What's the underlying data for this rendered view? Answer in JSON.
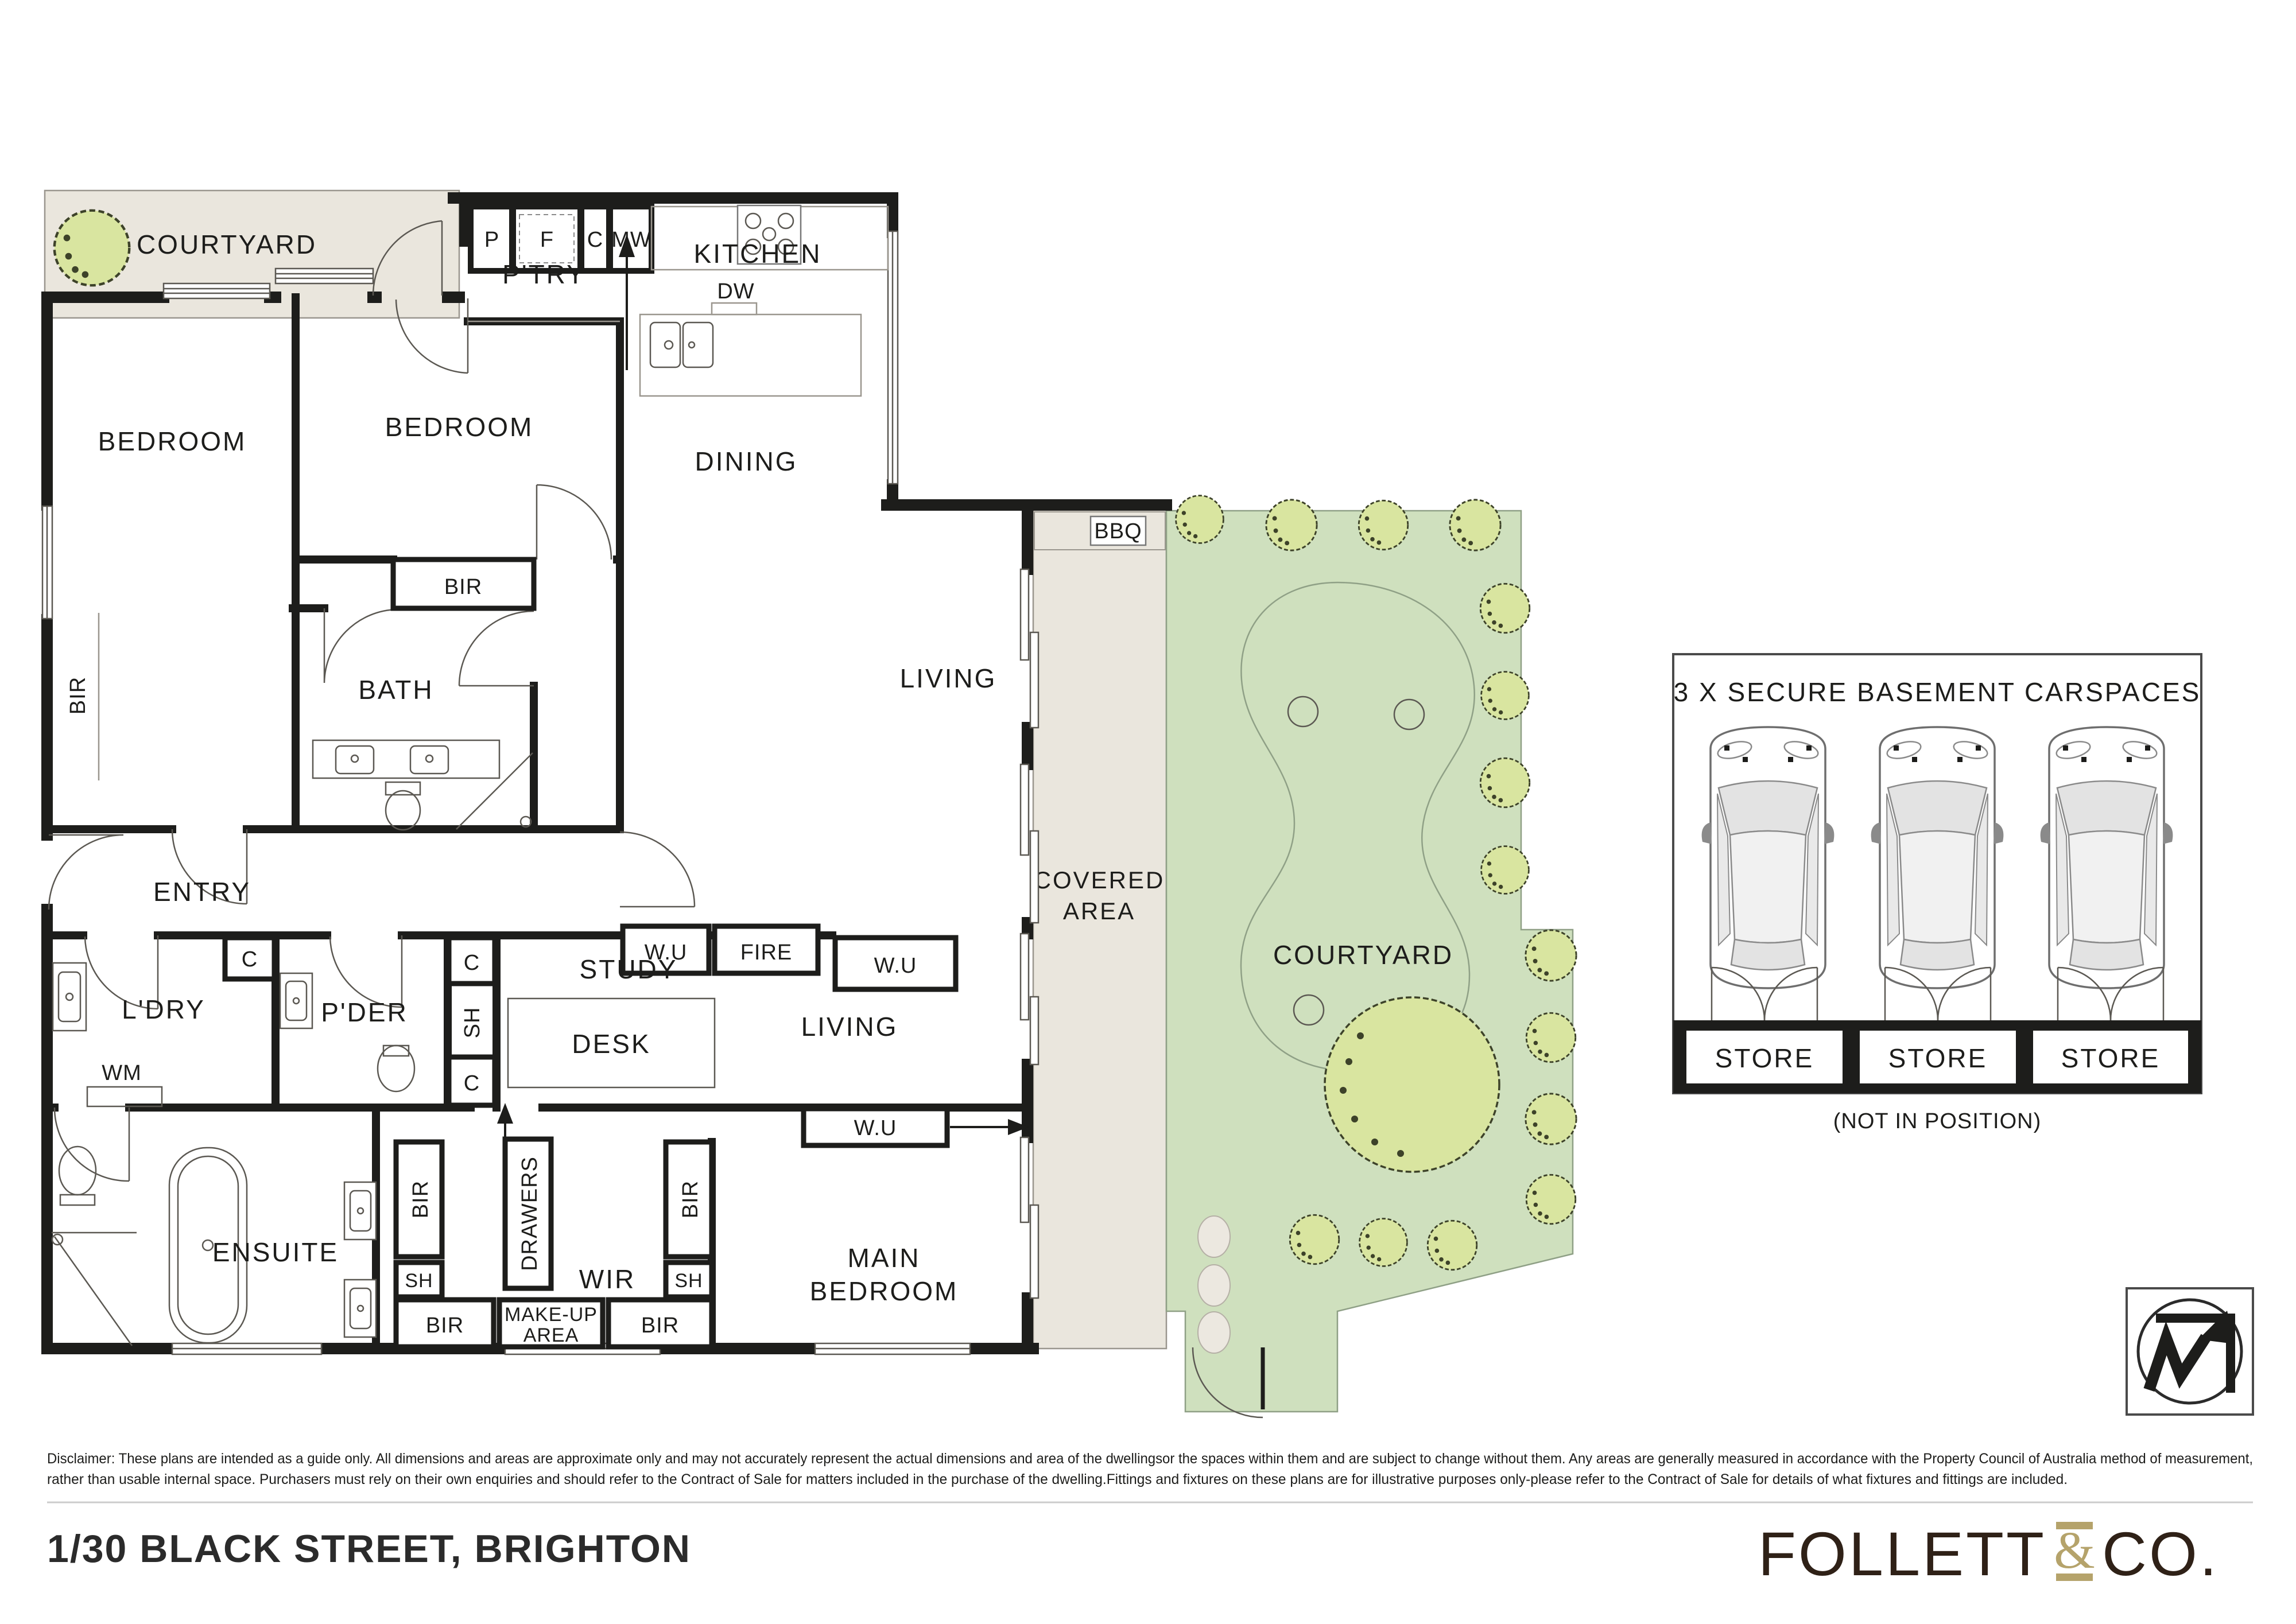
{
  "labels": {
    "courtyard": "COURTYARD",
    "ptry": "P'TRY",
    "kitchen": "KITCHEN",
    "dw": "DW",
    "dining": "DINING",
    "bedroom": "BEDROOM",
    "bir": "BIR",
    "bath": "BATH",
    "entry": "ENTRY",
    "living": "LIVING",
    "wu": "W.U",
    "fire": "FIRE",
    "study": "STUDY",
    "desk": "DESK",
    "ldry": "L'DRY",
    "wm": "WM",
    "pder": "P'DER",
    "c": "C",
    "sh": "SH",
    "p": "P",
    "f": "F",
    "mw": "MW",
    "bbq": "BBQ",
    "covered1": "COVERED",
    "covered2": "AREA",
    "courtyard_main": "COURTYARD",
    "main1": "MAIN",
    "main2": "BEDROOM",
    "ensuite": "ENSUITE",
    "wir": "WIR",
    "drawers": "DRAWERS",
    "makeup1": "MAKE-UP",
    "makeup2": "AREA"
  },
  "carspaces": {
    "title": "3 X SECURE BASEMENT CARSPACES",
    "store": "STORE",
    "note": "(NOT IN POSITION)"
  },
  "footer": {
    "disclaimer1": "Disclaimer: These plans are intended as a guide only. All dimensions and areas are approximate only and may not accurately represent the actual dimensions and area of the dwellingsor the spaces within them and are subject to change without them. Any areas are generally measured in accordance with the Property Council of Australia method of measurement,",
    "disclaimer2": "rather than usable internal space. Purchasers must rely on their own enquiries and should refer to the Contract of Sale for matters included in the purchase of the dwelling.Fittings and fixtures on these plans are for illustrative purposes only-please refer to the Contract of Sale for details of what fixtures and fittings are included.",
    "address": "1/30 BLACK STREET, BRIGHTON",
    "brand_left": "FOLLETT",
    "brand_amp": "&",
    "brand_right": "CO."
  },
  "colors": {
    "wall": "#1d1d1b",
    "paved": "#EAE6DD",
    "lawn": "#CFE0BE",
    "lawn_line": "#8fa086",
    "tree": "#D9E5A0",
    "stone": "#ECE8E0",
    "brand_brown": "#2F2117",
    "brand_gold": "#B5A36B"
  }
}
